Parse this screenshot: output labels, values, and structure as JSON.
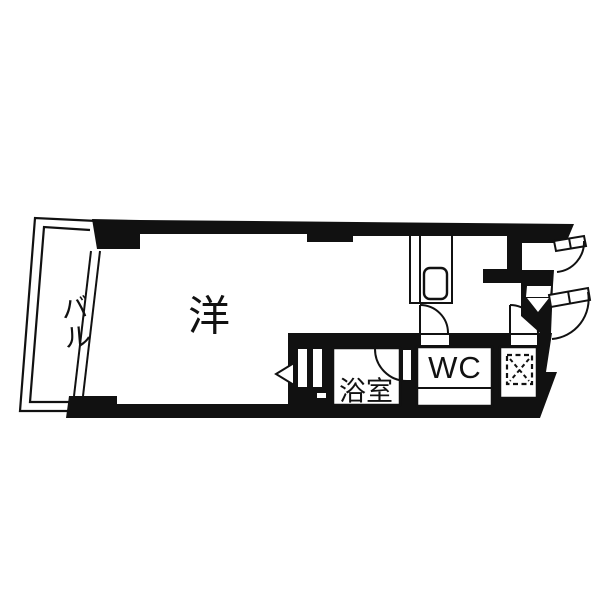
{
  "diagram_type": "apartment-floorplan",
  "colors": {
    "background": "#ffffff",
    "walls": "#111111",
    "lines": "#111111"
  },
  "rooms": {
    "balcony": {
      "label": "バル"
    },
    "main_room": {
      "label": "洋"
    },
    "bathroom": {
      "label": "浴室"
    },
    "toilet": {
      "label": "WC"
    }
  },
  "fixtures": [
    "kitchen-counter",
    "kitchen-sink",
    "washing-machine-pan",
    "entrance-door",
    "upper-right-door",
    "wc-door",
    "laundry-door",
    "bathroom-door",
    "bifold-door",
    "balcony-window"
  ]
}
